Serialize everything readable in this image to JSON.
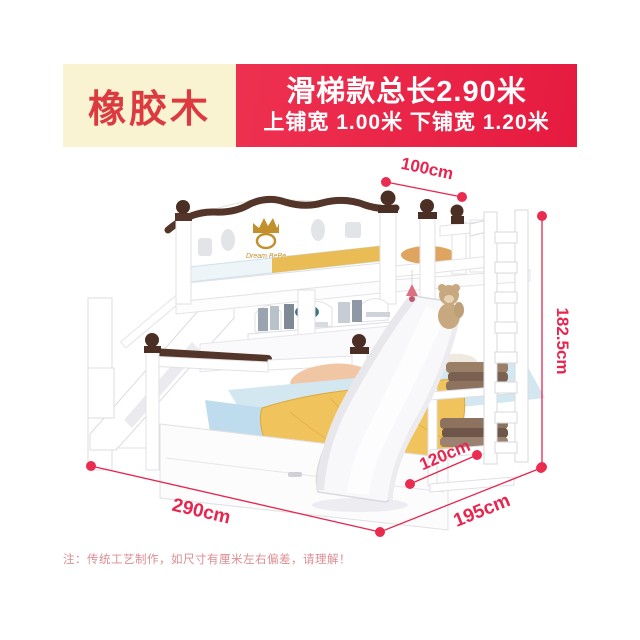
{
  "header": {
    "material_badge": "橡胶木",
    "banner_line1": "滑梯款总长2.90米",
    "banner_line2": "上铺宽 1.00米 下铺宽 1.20米"
  },
  "product": {
    "headboard_logo": "Dream BeBe"
  },
  "dimensions": {
    "upper_bunk_width": "100cm",
    "overall_height": "182.5cm",
    "slide_span": "120cm",
    "overall_length": "290cm",
    "overall_depth": "195cm"
  },
  "footnote": "注：传统工艺制作，如尺寸有厘米左右偏差，请理解！",
  "colors": {
    "accent_red": "#e8254e",
    "banner_red": "#e61a40",
    "badge_cream": "#faf3d2",
    "badge_text_red": "#dd3a40",
    "wood_dark_brown": "#4c2f24",
    "crown_gold": "#c2912e",
    "blanket_yellow": "#f0c35c",
    "bedding_blue": "#d3e7f0"
  }
}
